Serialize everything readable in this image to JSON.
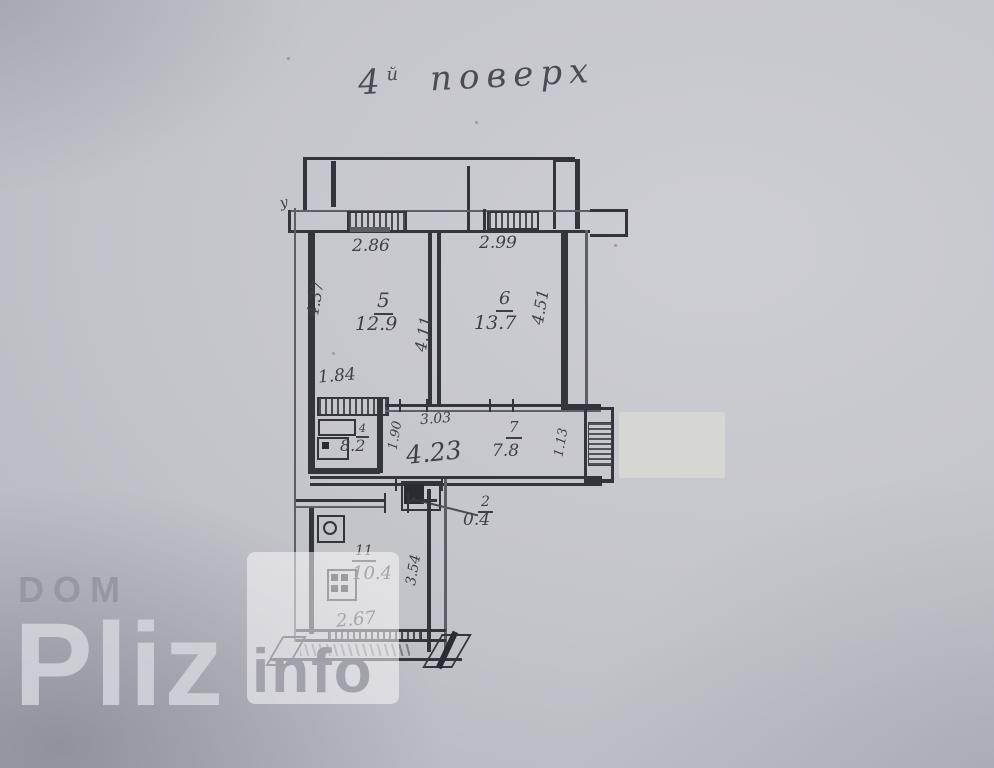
{
  "photo": {
    "title_prefix": "4",
    "title_sup": "й",
    "title_word": "поверх"
  },
  "plan": {
    "edge_mark": "у",
    "dims": {
      "window_left": "2.86",
      "window_right": "2.99",
      "room5_left_height": "4.37",
      "rooms_mid_height": "4.11",
      "room6_right_height": "4.51",
      "kitchen_width": "1.84",
      "hall_top_segment": "3.03",
      "kitchen_depth": "1.90",
      "hall_length": "4.23",
      "right_nook": "1.13",
      "bottom_room_width": "2.67",
      "bottom_room_height": "3.54"
    },
    "rooms": {
      "r5": {
        "num": "5",
        "area": "12.9"
      },
      "r6": {
        "num": "6",
        "area": "13.7"
      },
      "kitchen": {
        "num": "4",
        "area": "8.2"
      },
      "hall": {
        "num": "7",
        "area": "7.8"
      },
      "closet": {
        "num": "2",
        "area": "0.4"
      },
      "bottom": {
        "num": "11",
        "area": "10.4"
      }
    }
  },
  "watermark": {
    "dom": "DOM",
    "pliz": "Pliz",
    "info": "info"
  }
}
